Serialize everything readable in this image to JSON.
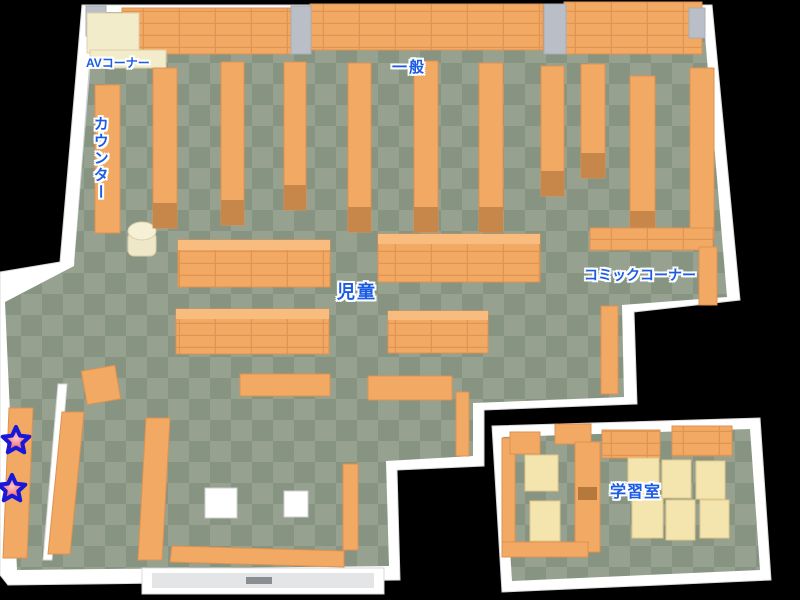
{
  "labels": {
    "av_corner": "AVコーナー",
    "general": "一般",
    "counter": "カウンター",
    "children": "児童",
    "comic_corner": "コミックコーナー",
    "study_room": "学習室"
  },
  "markers": {
    "star1_transform": "translate(16,441)",
    "star2_transform": "translate(12,489)"
  },
  "colors": {
    "background": "#000000",
    "wall_white": "#ffffff",
    "wall_shade": "#cdd0d5",
    "floor_light": "#96a18f",
    "floor_dark": "#879482",
    "shelf_orange": "#f2a963",
    "shelf_edge": "#dd9250",
    "shelf_cap": "#c8874a",
    "av_counter_cream": "#f3eccb",
    "table_cream": "#f4e4ae",
    "label_blue": "#1a5ce6",
    "star_red": "#e84848",
    "star_outline_blue": "#1818d8"
  }
}
